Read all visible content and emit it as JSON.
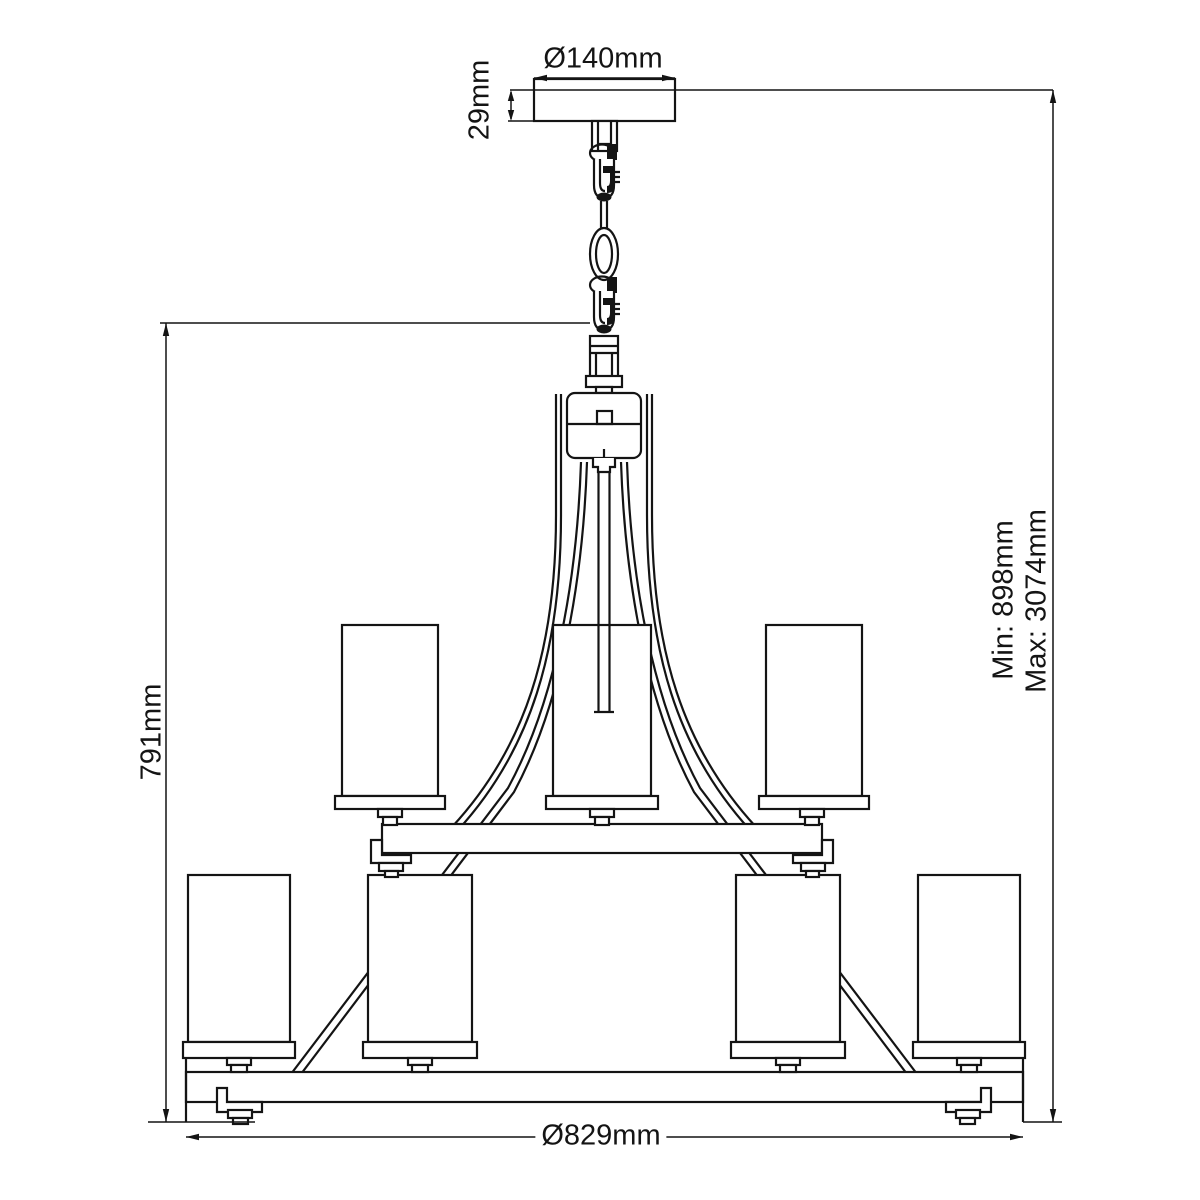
{
  "dimensions": {
    "canopy_diameter": "Ø140mm",
    "canopy_height": "29mm",
    "fixture_height": "791mm",
    "suspension_min": "Min: 898mm",
    "suspension_max": "Max: 3074mm",
    "fixture_diameter": "Ø829mm"
  },
  "colors": {
    "line": "#141414",
    "background": "#ffffff"
  }
}
